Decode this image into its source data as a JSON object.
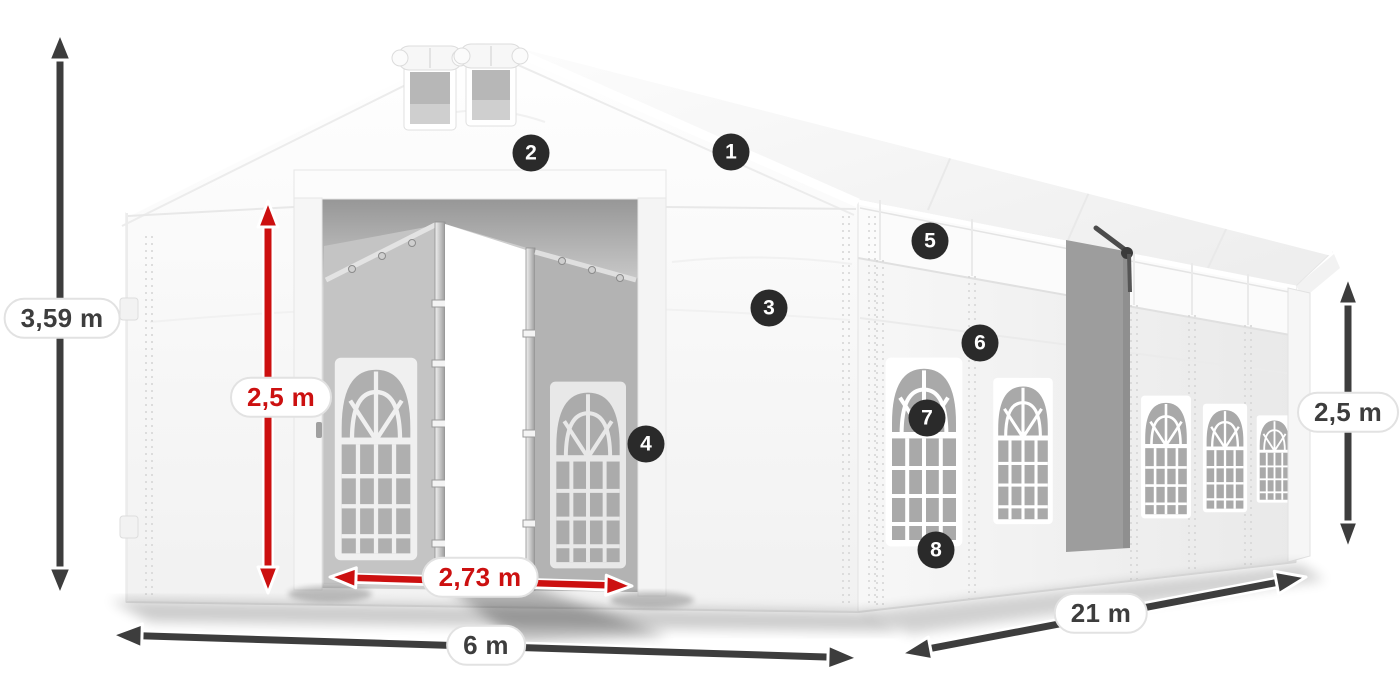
{
  "badges": [
    {
      "label": "1"
    },
    {
      "label": "2"
    },
    {
      "label": "3"
    },
    {
      "label": "4"
    },
    {
      "label": "5"
    },
    {
      "label": "6"
    },
    {
      "label": "7"
    },
    {
      "label": "8"
    }
  ],
  "dimensions": {
    "total_height": {
      "value": "3,59 m"
    },
    "door_height": {
      "value": "2,5 m"
    },
    "door_width": {
      "value": "2,73 m"
    },
    "front_width": {
      "value": "6 m"
    },
    "side_length": {
      "value": "21 m"
    },
    "side_wall_height": {
      "value": "2,5 m"
    }
  },
  "colors": {
    "dimension_dark": "#3d3d3d",
    "dimension_red": "#cc1010",
    "badge_bg": "#2a2a2a",
    "badge_text": "#ffffff"
  }
}
